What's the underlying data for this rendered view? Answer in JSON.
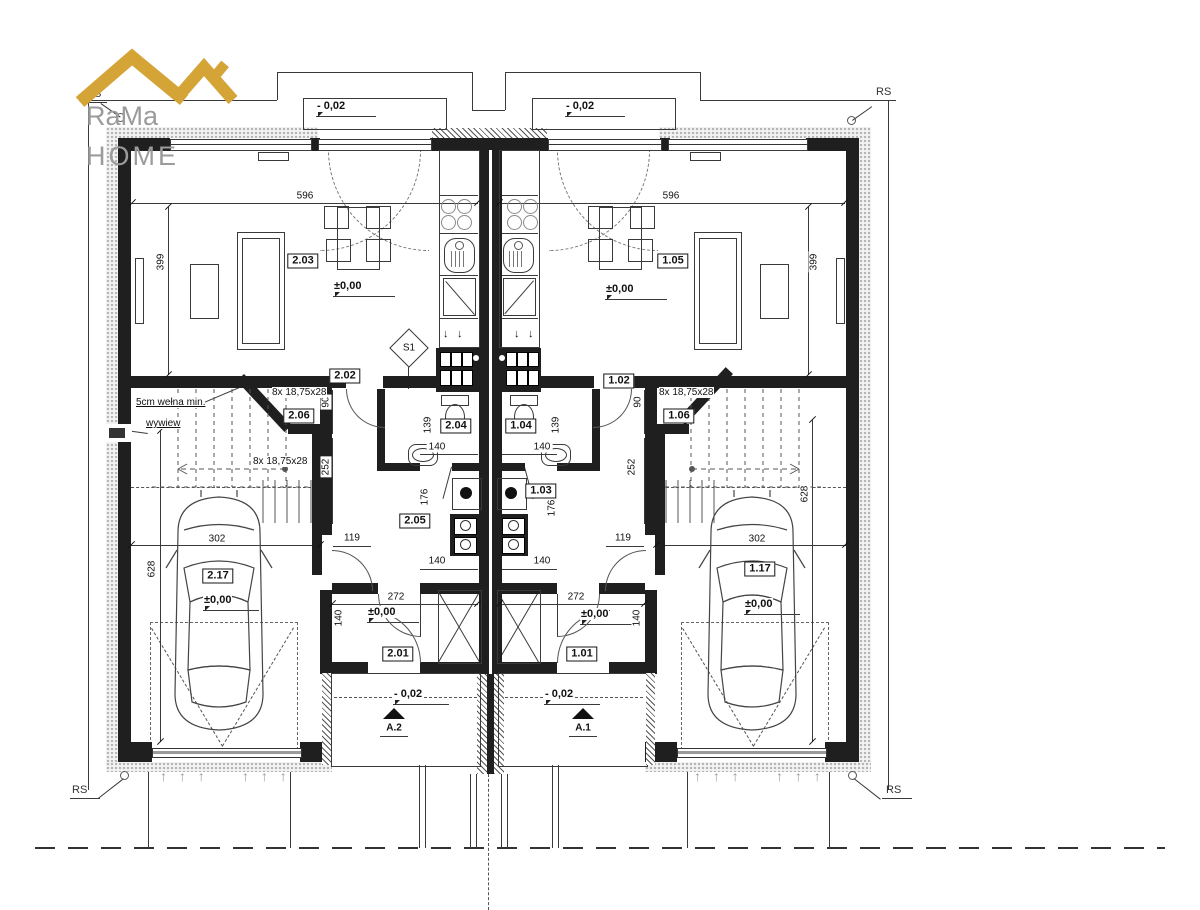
{
  "logo": {
    "line1": "RaMa",
    "line2": "HOME"
  },
  "site": {
    "corner_marker": "RS"
  },
  "symbols": {
    "schema_marker": "S1",
    "section_right": "A.1",
    "section_left": "A.2",
    "down_arrow": "↓",
    "garage_arrows": "↑ ↑ ↑"
  },
  "levels": {
    "ground": "±0,00",
    "entry": "- 0,02"
  },
  "rooms": {
    "left": {
      "living": "2.03",
      "corridor": "2.02",
      "bathroom": "2.04",
      "utility": "2.05",
      "stairs": "2.06",
      "hall": "2.01",
      "garage": "2.17"
    },
    "right": {
      "living": "1.05",
      "corridor": "1.02",
      "bathroom": "1.04",
      "utility": "1.03",
      "stairs": "1.06",
      "hall": "1.01",
      "garage": "1.17"
    }
  },
  "dimensions": {
    "living_width": "596",
    "living_depth": "399",
    "stair_width": "90",
    "stair_depth": "252",
    "garage_depth": "628",
    "garage_width": "302",
    "entry_width": "272",
    "bathroom_depth": "139",
    "bathroom_width": "140",
    "utility_depth": "176",
    "door_clear": "119",
    "hall_door": "140"
  },
  "notes": {
    "insulation": "5cm wełna min.",
    "vent": "wywiew",
    "stair_run": "8x 18,75x28"
  },
  "colors": {
    "wall": "#1f1f1f",
    "logo_gold": "#D4A437",
    "logo_text": "#9b9b9b"
  }
}
